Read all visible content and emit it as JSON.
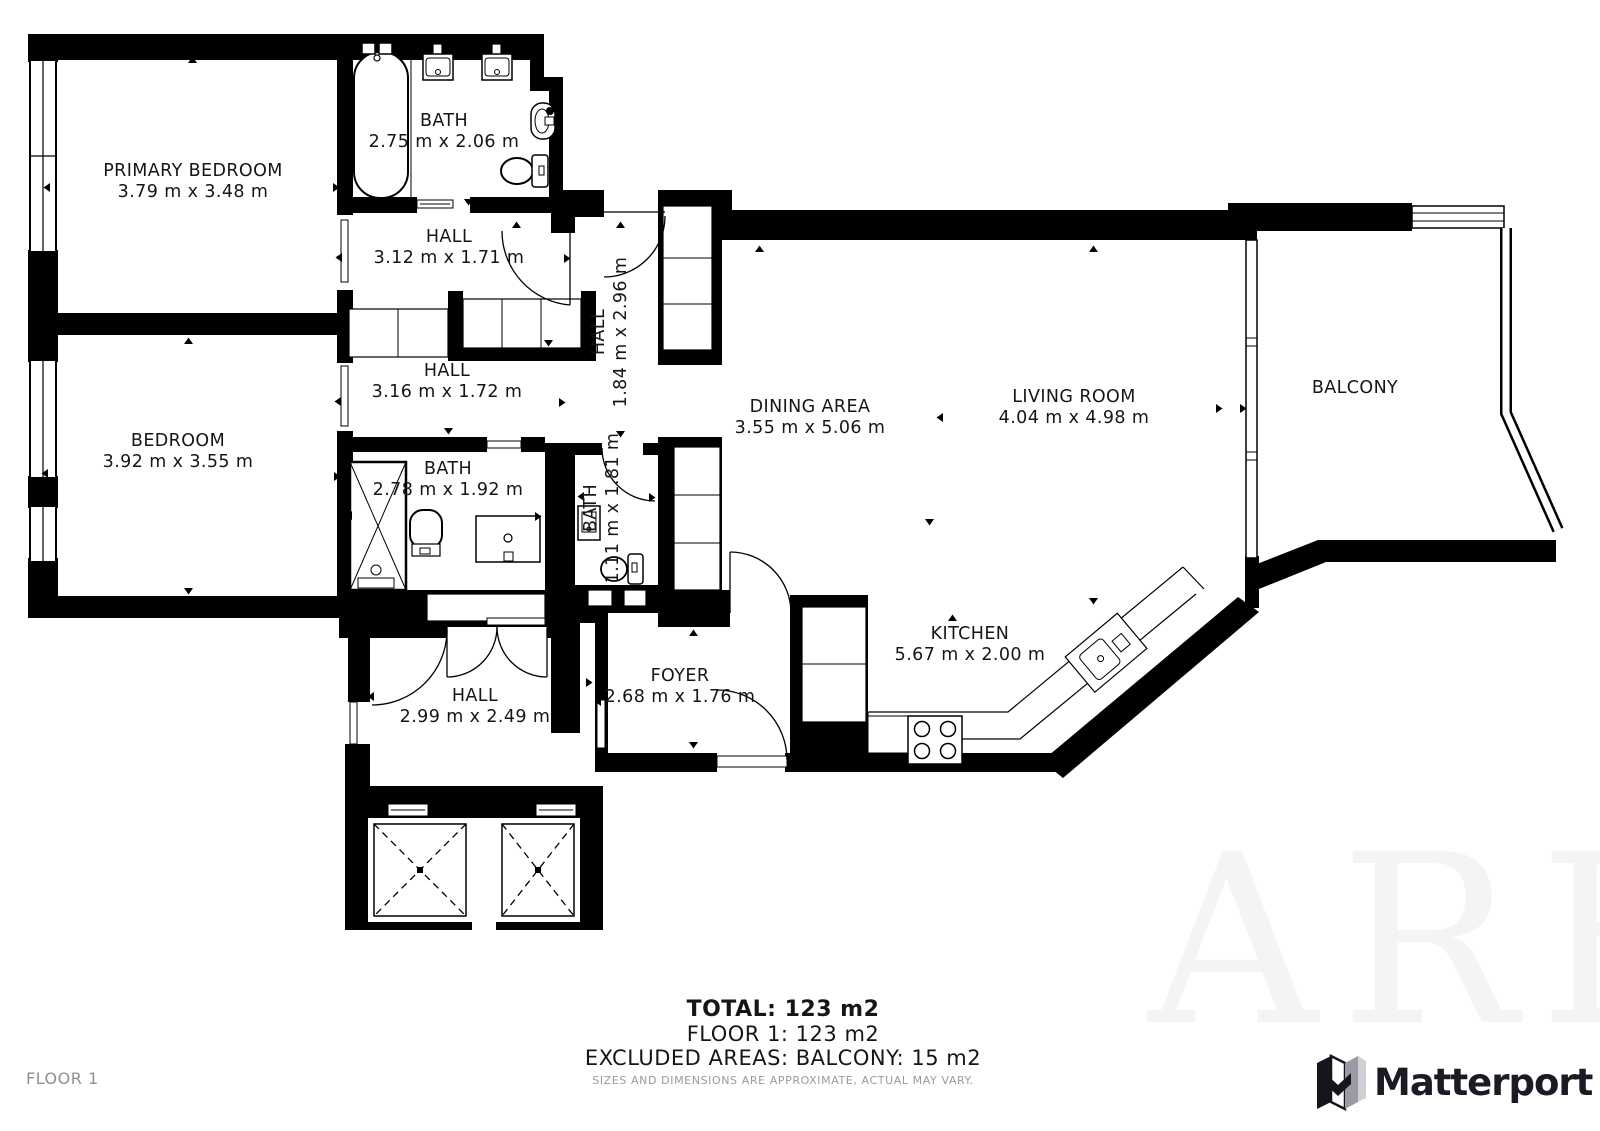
{
  "rooms": [
    {
      "id": "primary-bedroom",
      "name": "PRIMARY BEDROOM",
      "dims": "3.79 m x 3.48 m"
    },
    {
      "id": "bath-main",
      "name": "BATH",
      "dims": "2.75 m x 2.06 m"
    },
    {
      "id": "hall-top",
      "name": "HALL",
      "dims": "3.12 m x 1.71 m"
    },
    {
      "id": "hall-vertical",
      "name": "HALL",
      "dims": "1.84 m x 2.96 m"
    },
    {
      "id": "bedroom",
      "name": "BEDROOM",
      "dims": "3.92 m x 3.55 m"
    },
    {
      "id": "hall-mid",
      "name": "HALL",
      "dims": "3.16 m x 1.72 m"
    },
    {
      "id": "bath-second",
      "name": "BATH",
      "dims": "2.78 m x 1.92 m"
    },
    {
      "id": "bath-small",
      "name": "BATH",
      "dims": "1.11 m x 1.81 m"
    },
    {
      "id": "dining-area",
      "name": "DINING AREA",
      "dims": "3.55 m x 5.06 m"
    },
    {
      "id": "living-room",
      "name": "LIVING ROOM",
      "dims": "4.04 m x 4.98 m"
    },
    {
      "id": "balcony",
      "name": "BALCONY",
      "dims": ""
    },
    {
      "id": "kitchen",
      "name": "KITCHEN",
      "dims": "5.67 m x 2.00 m"
    },
    {
      "id": "foyer",
      "name": "FOYER",
      "dims": "2.68 m x 1.76 m"
    },
    {
      "id": "hall-entry",
      "name": "HALL",
      "dims": "2.99 m x 2.49 m"
    }
  ],
  "summary": {
    "total": "TOTAL: 123 m2",
    "floor": "FLOOR 1: 123 m2",
    "excluded": "EXCLUDED AREAS: BALCONY: 15 m2",
    "disclaimer": "SIZES AND DIMENSIONS ARE APPROXIMATE, ACTUAL MAY VARY."
  },
  "meta": {
    "floor_label": "FLOOR 1",
    "brand": "Matterport",
    "watermark": "ARE",
    "wall_color": "#000000",
    "icons": [
      "bathtub-icon",
      "sink-icon",
      "toilet-icon",
      "shower-icon",
      "stove-icon",
      "kitchen-sink-icon",
      "wardrobe-icon",
      "elevator-icon",
      "door-arc-icon",
      "window-icon"
    ]
  }
}
